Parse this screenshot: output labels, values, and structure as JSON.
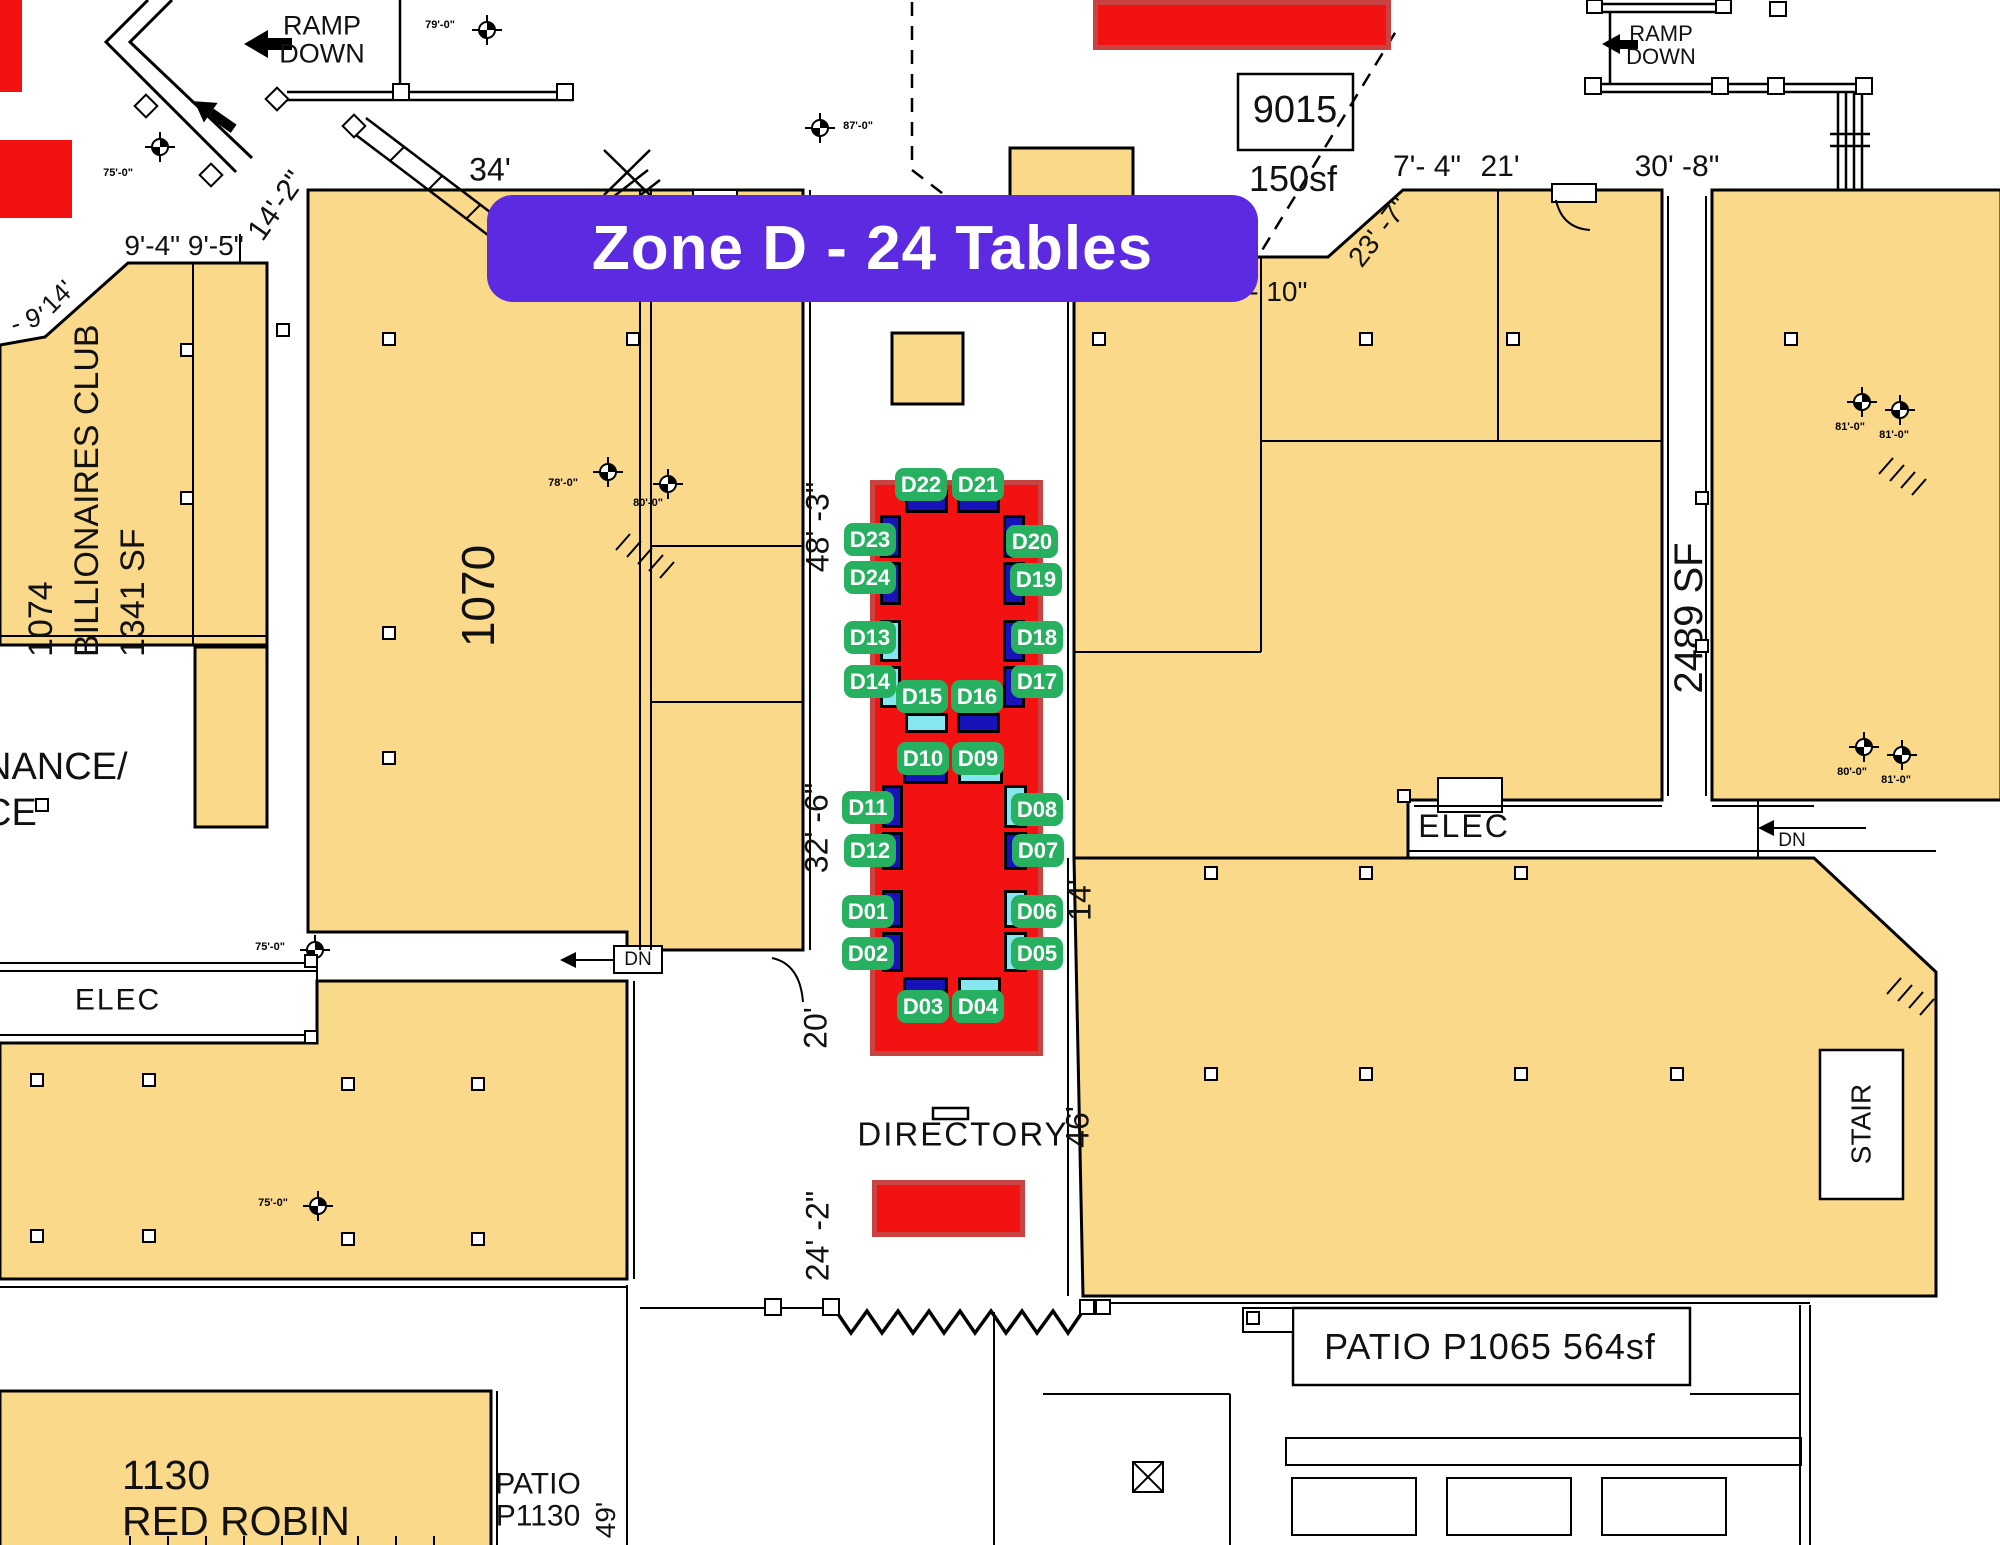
{
  "banner": {
    "label": "Zone D - 24 Tables"
  },
  "colors": {
    "accent_purple": "#5c2ae0",
    "zone_red": "#f31212",
    "zone_red_border": "#c94343",
    "badge_green": "#28b061",
    "table_blue": "#1713b8",
    "table_cyan": "#86e7f0",
    "floor_yellow": "#fbd98a",
    "line_black": "#000000"
  },
  "zone": {
    "name": "Zone D",
    "table_count": 24,
    "tables": [
      {
        "id": "D01",
        "variant": "blue",
        "badge": {
          "x": 868,
          "y": 911
        },
        "rect": {
          "x": 882,
          "y": 890,
          "w": 21,
          "h": 38
        }
      },
      {
        "id": "D02",
        "variant": "blue",
        "badge": {
          "x": 868,
          "y": 953
        },
        "rect": {
          "x": 882,
          "y": 932,
          "w": 21,
          "h": 40
        }
      },
      {
        "id": "D03",
        "variant": "blue",
        "badge": {
          "x": 923,
          "y": 1006
        },
        "rect": {
          "x": 903,
          "y": 977,
          "w": 45,
          "h": 16
        }
      },
      {
        "id": "D04",
        "variant": "cyan",
        "badge": {
          "x": 978,
          "y": 1006
        },
        "rect": {
          "x": 958,
          "y": 977,
          "w": 43,
          "h": 16
        }
      },
      {
        "id": "D05",
        "variant": "cyan",
        "badge": {
          "x": 1037,
          "y": 953
        },
        "rect": {
          "x": 1004,
          "y": 932,
          "w": 23,
          "h": 40
        }
      },
      {
        "id": "D06",
        "variant": "cyan",
        "badge": {
          "x": 1037,
          "y": 911
        },
        "rect": {
          "x": 1004,
          "y": 890,
          "w": 23,
          "h": 38
        }
      },
      {
        "id": "D07",
        "variant": "blue",
        "badge": {
          "x": 1038,
          "y": 850
        },
        "rect": {
          "x": 1004,
          "y": 832,
          "w": 23,
          "h": 38
        }
      },
      {
        "id": "D08",
        "variant": "cyan",
        "badge": {
          "x": 1037,
          "y": 809
        },
        "rect": {
          "x": 1004,
          "y": 785,
          "w": 23,
          "h": 43
        }
      },
      {
        "id": "D09",
        "variant": "cyan",
        "badge": {
          "x": 978,
          "y": 758
        },
        "rect": {
          "x": 958,
          "y": 768,
          "w": 45,
          "h": 16
        }
      },
      {
        "id": "D10",
        "variant": "blue",
        "badge": {
          "x": 923,
          "y": 758
        },
        "rect": {
          "x": 903,
          "y": 768,
          "w": 45,
          "h": 16
        }
      },
      {
        "id": "D11",
        "variant": "blue",
        "badge": {
          "x": 868,
          "y": 807
        },
        "rect": {
          "x": 882,
          "y": 785,
          "w": 21,
          "h": 43
        }
      },
      {
        "id": "D12",
        "variant": "blue",
        "badge": {
          "x": 870,
          "y": 850
        },
        "rect": {
          "x": 882,
          "y": 832,
          "w": 21,
          "h": 38
        }
      },
      {
        "id": "D13",
        "variant": "cyan",
        "badge": {
          "x": 870,
          "y": 637
        },
        "rect": {
          "x": 880,
          "y": 620,
          "w": 21,
          "h": 42
        }
      },
      {
        "id": "D14",
        "variant": "cyan",
        "badge": {
          "x": 870,
          "y": 681
        },
        "rect": {
          "x": 880,
          "y": 666,
          "w": 21,
          "h": 42
        }
      },
      {
        "id": "D15",
        "variant": "cyan",
        "badge": {
          "x": 922,
          "y": 696
        },
        "rect": {
          "x": 905,
          "y": 713,
          "w": 43,
          "h": 20
        }
      },
      {
        "id": "D16",
        "variant": "blue",
        "badge": {
          "x": 977,
          "y": 696
        },
        "rect": {
          "x": 957,
          "y": 713,
          "w": 43,
          "h": 20
        }
      },
      {
        "id": "D17",
        "variant": "blue",
        "badge": {
          "x": 1037,
          "y": 681
        },
        "rect": {
          "x": 1003,
          "y": 666,
          "w": 22,
          "h": 42
        }
      },
      {
        "id": "D18",
        "variant": "blue",
        "badge": {
          "x": 1037,
          "y": 637
        },
        "rect": {
          "x": 1003,
          "y": 620,
          "w": 22,
          "h": 42
        }
      },
      {
        "id": "D19",
        "variant": "blue",
        "badge": {
          "x": 1036,
          "y": 579
        },
        "rect": {
          "x": 1003,
          "y": 562,
          "w": 22,
          "h": 43
        }
      },
      {
        "id": "D20",
        "variant": "blue",
        "badge": {
          "x": 1032,
          "y": 541
        },
        "rect": {
          "x": 1003,
          "y": 515,
          "w": 22,
          "h": 43
        }
      },
      {
        "id": "D21",
        "variant": "blue",
        "badge": {
          "x": 978,
          "y": 484
        },
        "rect": {
          "x": 957,
          "y": 490,
          "w": 43,
          "h": 23
        }
      },
      {
        "id": "D22",
        "variant": "blue",
        "badge": {
          "x": 921,
          "y": 484
        },
        "rect": {
          "x": 905,
          "y": 490,
          "w": 43,
          "h": 23
        }
      },
      {
        "id": "D23",
        "variant": "blue",
        "badge": {
          "x": 870,
          "y": 539
        },
        "rect": {
          "x": 880,
          "y": 515,
          "w": 21,
          "h": 43
        }
      },
      {
        "id": "D24",
        "variant": "blue",
        "badge": {
          "x": 870,
          "y": 577
        },
        "rect": {
          "x": 880,
          "y": 562,
          "w": 21,
          "h": 43
        }
      }
    ]
  },
  "red_zones": [
    {
      "x": 870,
      "y": 480,
      "w": 173,
      "h": 576,
      "bordered": true
    },
    {
      "x": 872,
      "y": 1180,
      "w": 153,
      "h": 57,
      "bordered": true
    },
    {
      "x": 1093,
      "y": 0,
      "w": 298,
      "h": 50,
      "bordered": true
    },
    {
      "x": 0,
      "y": 0,
      "w": 22,
      "h": 92,
      "bordered": false
    },
    {
      "x": 0,
      "y": 140,
      "w": 72,
      "h": 78,
      "bordered": false
    }
  ],
  "rooms": {
    "billionaires": {
      "lines": [
        "1074",
        "BILLIONAIRES CLUB",
        "1341 SF"
      ]
    },
    "room_1070": {
      "label": "1070"
    },
    "room_2489": {
      "label": "2489 SF"
    },
    "red_robin": {
      "lines": [
        "1130",
        "RED ROBIN"
      ]
    },
    "patio_1130": {
      "lines": [
        "PATIO",
        "P1130"
      ]
    },
    "patio_1065": {
      "label": "PATIO P1065 564sf"
    },
    "stall_9015": {
      "number": "9015",
      "area": "150sf"
    },
    "maintenance": {
      "lines": [
        "NANCE/",
        "CE"
      ]
    },
    "elec_left": "ELEC",
    "elec_right": "ELEC",
    "stair": "STAIR",
    "directory": "DIRECTORY",
    "dn_left": "DN",
    "dn_right": "DN",
    "ramp_left": {
      "lines": [
        "RAMP",
        "DOWN"
      ]
    },
    "ramp_right": {
      "lines": [
        "RAMP",
        "DOWN"
      ]
    }
  },
  "dimensions": [
    {
      "text": "34'",
      "x": 490,
      "y": 170,
      "rot": 0,
      "size": 32
    },
    {
      "text": "14'-2\"",
      "x": 277,
      "y": 206,
      "rot": -55,
      "size": 30
    },
    {
      "text": "9'-4\" 9'-5\"",
      "x": 184,
      "y": 246,
      "rot": 0,
      "size": 28
    },
    {
      "text": "14'",
      "x": 58,
      "y": 297,
      "rot": -45,
      "size": 26
    },
    {
      "text": "- 9'",
      "x": 28,
      "y": 320,
      "rot": -18,
      "size": 26
    },
    {
      "text": "7'- 4\"",
      "x": 1427,
      "y": 167,
      "rot": 0,
      "size": 30
    },
    {
      "text": "21'",
      "x": 1500,
      "y": 167,
      "rot": 0,
      "size": 30
    },
    {
      "text": "30' -8\"",
      "x": 1677,
      "y": 167,
      "rot": 0,
      "size": 30
    },
    {
      "text": "7' - 10\"",
      "x": 1264,
      "y": 292,
      "rot": 0,
      "size": 28
    },
    {
      "text": "23' -7\"",
      "x": 1379,
      "y": 232,
      "rot": -52,
      "size": 28
    },
    {
      "text": "48' -3\"",
      "x": 818,
      "y": 527,
      "rot": -90,
      "size": 32
    },
    {
      "text": "32' -6\"",
      "x": 817,
      "y": 828,
      "rot": -90,
      "size": 32
    },
    {
      "text": "20'",
      "x": 816,
      "y": 1028,
      "rot": -90,
      "size": 32
    },
    {
      "text": "24' -2\"",
      "x": 818,
      "y": 1236,
      "rot": -90,
      "size": 32
    },
    {
      "text": "14'",
      "x": 1080,
      "y": 900,
      "rot": -90,
      "size": 32
    },
    {
      "text": "46'",
      "x": 1078,
      "y": 1127,
      "rot": -90,
      "size": 32
    },
    {
      "text": "49'",
      "x": 606,
      "y": 1520,
      "rot": -90,
      "size": 28
    }
  ],
  "survey_markers": [
    {
      "x": 487,
      "y": 30,
      "label": "79'-0\"",
      "lx": 440,
      "ly": 25
    },
    {
      "x": 160,
      "y": 147,
      "label": "75'-0\"",
      "lx": 118,
      "ly": 173
    },
    {
      "x": 820,
      "y": 128,
      "label": "87'-0\"",
      "lx": 858,
      "ly": 126
    },
    {
      "x": 608,
      "y": 472,
      "label": "78'-0\"",
      "lx": 563,
      "ly": 483
    },
    {
      "x": 668,
      "y": 484,
      "label": "80'-0\"",
      "lx": 648,
      "ly": 503
    },
    {
      "x": 315,
      "y": 950,
      "label": "75'-0\"",
      "lx": 270,
      "ly": 947
    },
    {
      "x": 318,
      "y": 1206,
      "label": "75'-0\"",
      "lx": 273,
      "ly": 1203
    },
    {
      "x": 1862,
      "y": 402,
      "label": "81'-0\"",
      "lx": 1850,
      "ly": 427
    },
    {
      "x": 1900,
      "y": 410,
      "label": "81'-0\"",
      "lx": 1894,
      "ly": 435
    },
    {
      "x": 1864,
      "y": 747,
      "label": "80'-0\"",
      "lx": 1852,
      "ly": 772
    },
    {
      "x": 1902,
      "y": 755,
      "label": "81'-0\"",
      "lx": 1896,
      "ly": 780
    }
  ],
  "wall_squares": [
    [
      389,
      339
    ],
    [
      633,
      339
    ],
    [
      1099,
      339
    ],
    [
      1366,
      339
    ],
    [
      1513,
      339
    ],
    [
      1791,
      339
    ],
    [
      389,
      633
    ],
    [
      389,
      758
    ],
    [
      42,
      805
    ],
    [
      187,
      350
    ],
    [
      187,
      498
    ],
    [
      283,
      330
    ],
    [
      37,
      1080
    ],
    [
      149,
      1080
    ],
    [
      348,
      1084
    ],
    [
      478,
      1084
    ],
    [
      37,
      1236
    ],
    [
      149,
      1236
    ],
    [
      348,
      1239
    ],
    [
      478,
      1239
    ],
    [
      1211,
      873
    ],
    [
      1366,
      873
    ],
    [
      1521,
      873
    ],
    [
      1211,
      1074
    ],
    [
      1366,
      1074
    ],
    [
      1521,
      1074
    ],
    [
      1677,
      1074
    ],
    [
      1702,
      498
    ],
    [
      1702,
      646
    ],
    [
      311,
      961
    ],
    [
      311,
      1037
    ],
    [
      1404,
      796
    ]
  ]
}
